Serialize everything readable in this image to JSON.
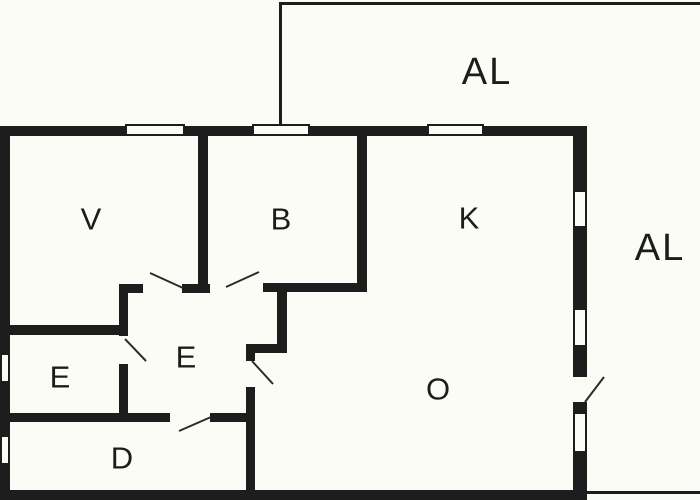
{
  "colors": {
    "wall": "#1d1d1d",
    "background": "#fcfcf6",
    "label": "#1c1c1c"
  },
  "rooms": {
    "balcony_top": {
      "label": "AL"
    },
    "balcony_right": {
      "label": "AL"
    },
    "room_v": {
      "label": "V"
    },
    "room_b": {
      "label": "B"
    },
    "room_k": {
      "label": "K"
    },
    "hall_e": {
      "label": "E"
    },
    "small_e": {
      "label": "E"
    },
    "room_d": {
      "label": "D"
    },
    "room_o": {
      "label": "O"
    }
  }
}
